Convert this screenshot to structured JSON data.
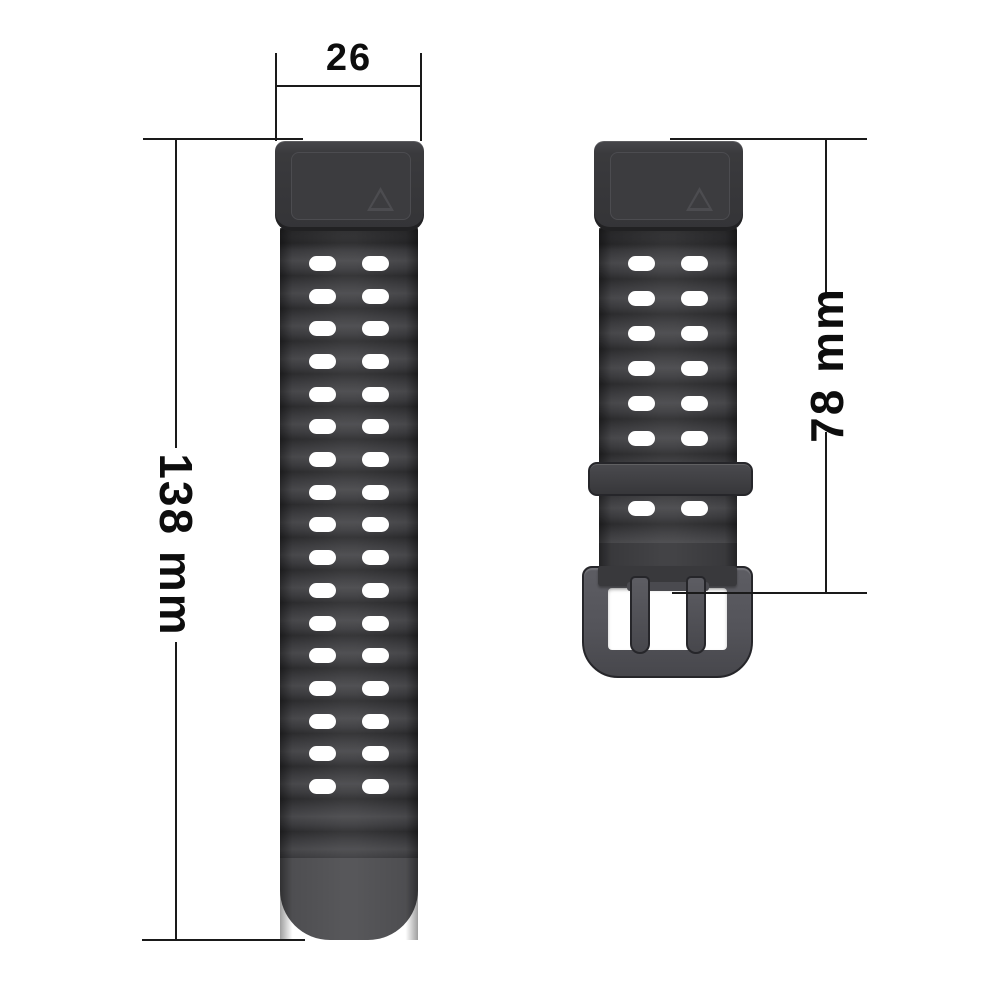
{
  "diagram_title": "watch-strap-dimension-diagram",
  "dimensions": {
    "lug_width": {
      "label": "26"
    },
    "long_strap_length": {
      "label": "138 mm"
    },
    "buckle_strap_length": {
      "label": "78 mm"
    }
  },
  "product": {
    "left_strap": {
      "name": "long strap piece with vent holes and rounded tip",
      "hole_rows": 17,
      "hole_cols": 2
    },
    "right_strap": {
      "name": "short strap piece with keeper loop and pin buckle",
      "hole_rows_above_keeper": 6,
      "hole_rows_below_keeper": 1,
      "hole_cols": 2
    }
  },
  "colors": {
    "page_bg": "#ffffff",
    "line": "#1a1a1a",
    "ink": "#0d0d0d",
    "strap_dark": "#39393c",
    "ridge_light": "#48484b",
    "ridge_mid": "#3b3b3e",
    "ridge_dark": "#2c2c2e",
    "connector": "#3a3a3d",
    "panel": "#3c3c3f",
    "panel_edge": "#4c4c50",
    "tip": "#4e4e51",
    "buckle_frame": "#54545a",
    "buckle_border": "#26262a",
    "hole": "#ffffff"
  }
}
